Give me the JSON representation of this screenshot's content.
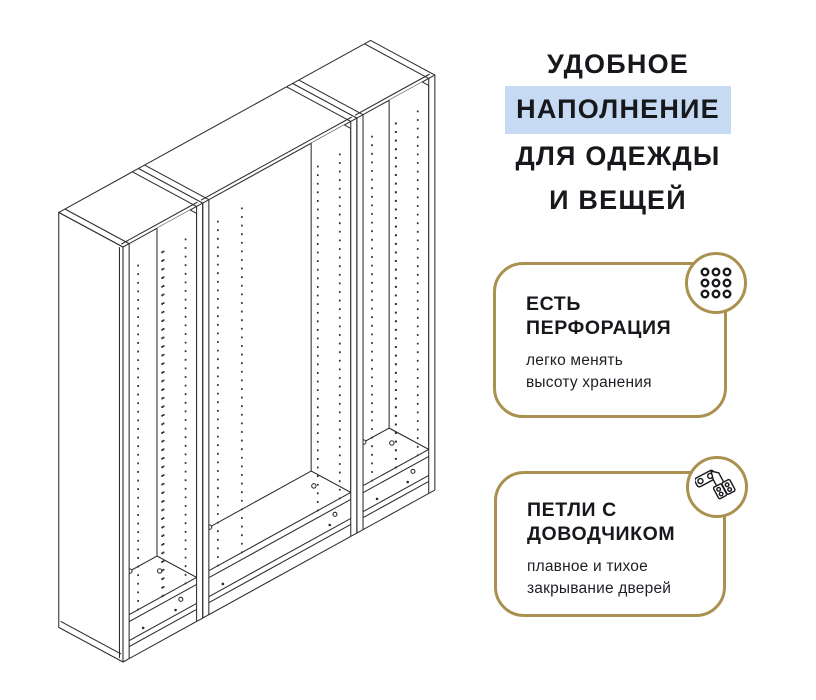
{
  "poster": {
    "background": "#ffffff",
    "accent_gold": "#ab9150",
    "highlight_blue": "#c6dbf3",
    "text_color": "#17181c",
    "line_color": "#2c2c30"
  },
  "heading": {
    "lines": [
      {
        "text": "УДОБНОЕ",
        "highlighted": false
      },
      {
        "text": "НАПОЛНЕНИЕ",
        "highlighted": true
      },
      {
        "text": "ДЛЯ ОДЕЖДЫ",
        "highlighted": false
      },
      {
        "text": "И ВЕЩЕЙ",
        "highlighted": false
      }
    ]
  },
  "features": [
    {
      "icon": "perforation-icon",
      "title": [
        "ЕСТЬ",
        "ПЕРФОРАЦИЯ"
      ],
      "description": [
        "легко менять",
        "высоту хранения"
      ]
    },
    {
      "icon": "hinge-icon",
      "title": [
        "ПЕТЛИ С",
        "ДОВОДЧИКОМ"
      ],
      "description": [
        "плавное и тихое",
        "закрывание дверей"
      ]
    }
  ],
  "illustration": {
    "icon": "wardrobe-frame-drawing"
  }
}
